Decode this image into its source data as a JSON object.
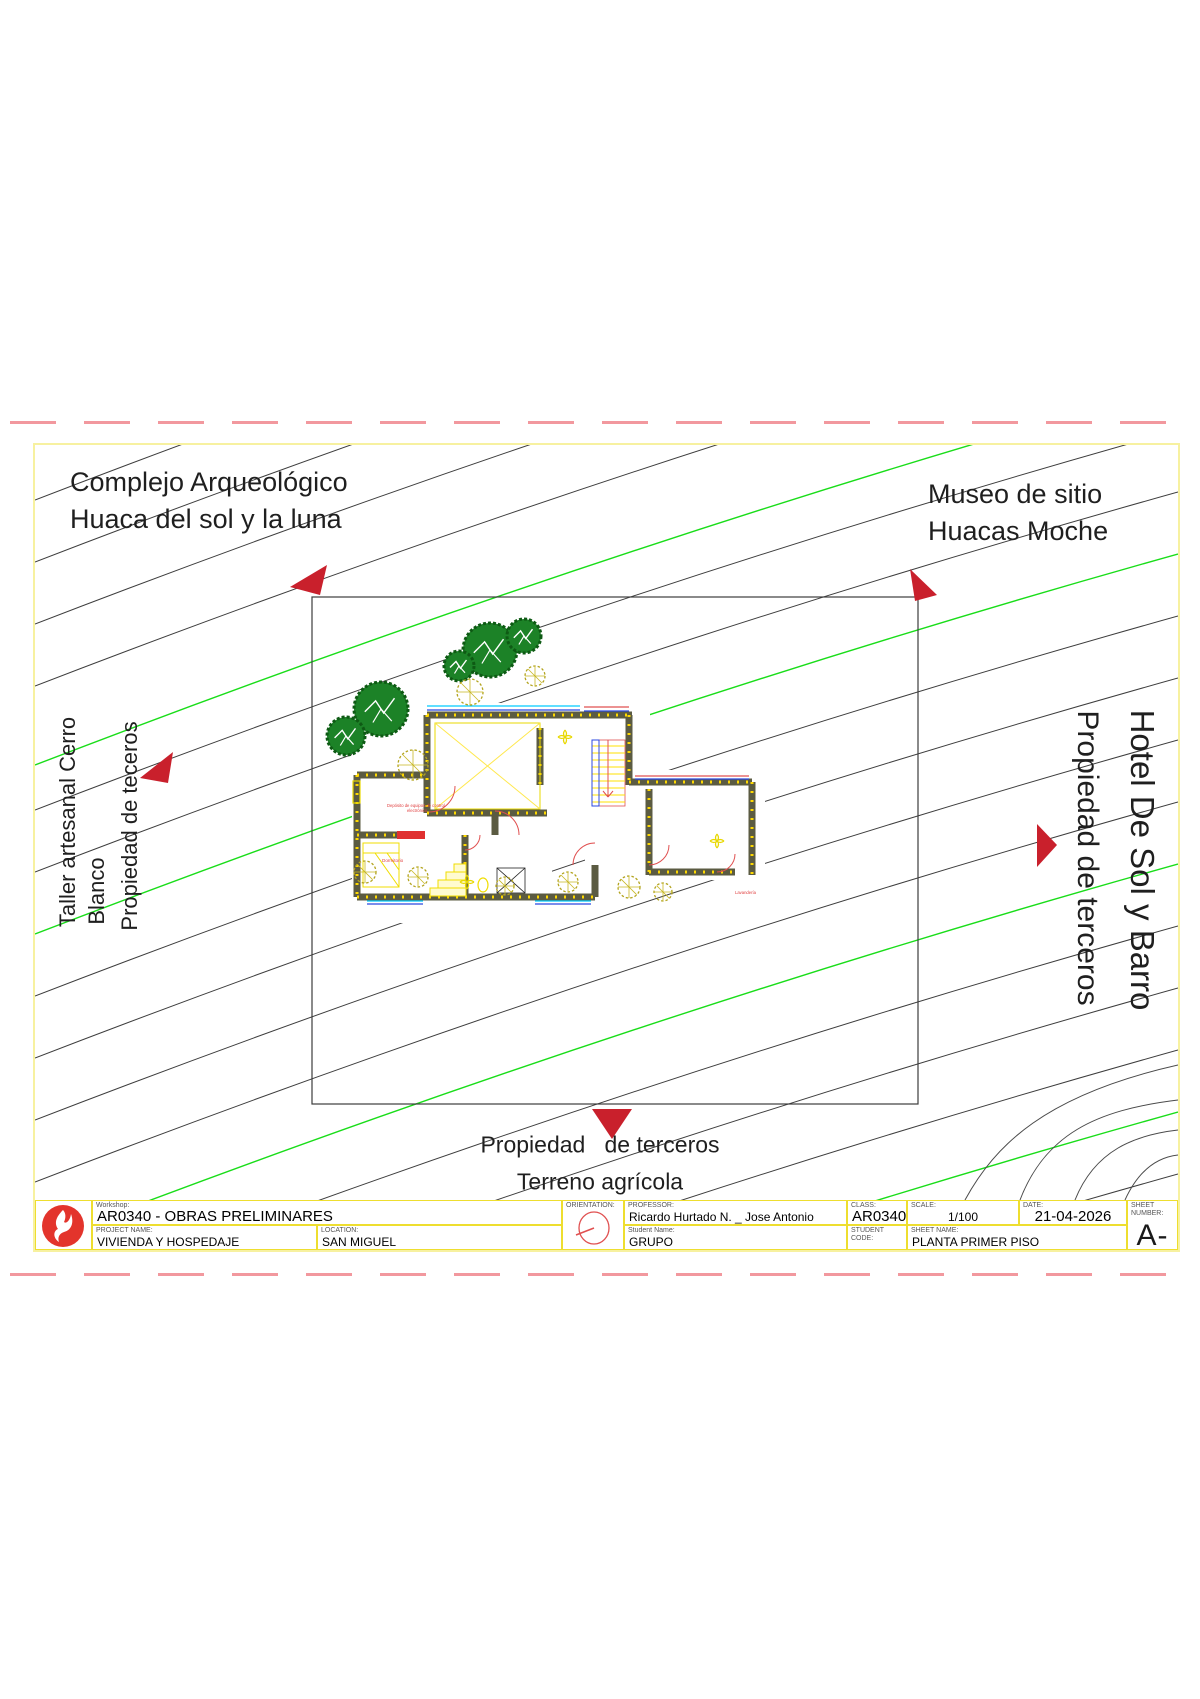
{
  "annotations": {
    "top_left_line1": "Complejo Arqueológico",
    "top_left_line2": "Huaca del sol y la luna",
    "top_right_line1": "Museo de sitio",
    "top_right_line2": "Huacas Moche",
    "left_line1": "Taller artesanal Cerro",
    "left_line2": "Blanco",
    "left_line3": "Propiedad de teceros",
    "right_inner": "Propiedad de terceros",
    "right_outer": "Hotel De Sol y Barro",
    "bottom_line1": "Propiedad   de terceros",
    "bottom_line2": "Terreno agrícola"
  },
  "plan_labels": {
    "storage_line1": "Depósito de equipos de control",
    "storage_line2": "electrónico",
    "bedroom": "Dormitorio",
    "laundry": "Lavandería"
  },
  "titleblock": {
    "workshop_label": "Workshop:",
    "workshop": "AR0340 - OBRAS PRELIMINARES",
    "project_label": "PROJECT NAME:",
    "project": "VIVIENDA Y HOSPEDAJE ECOSOSTENIB.",
    "location_label": "LOCATION:",
    "location": "SAN MIGUEL",
    "orientation_label": "ORIENTATION:",
    "professor_label": "PROFESSOR:",
    "professor": "Ricardo Hurtado N. _ Jose Antonio Yengle C.",
    "student_label": "Student Name:",
    "student": "GRUPO",
    "class_label": "CLASS:",
    "class": "AR0340",
    "student_code_label": "STUDENT CODE:",
    "student_code": "",
    "scale_label": "SCALE:",
    "scale": "1/100",
    "sheet_name_label": "SHEET NAME:",
    "sheet_name": "PLANTA PRIMER PISO",
    "date_label": "DATE:",
    "date": "21-04-2026",
    "sheet_number_label": "SHEET NUMBER:",
    "sheet_number": "A-00"
  },
  "colors": {
    "contour_black": "#3d3d3d",
    "contour_green": "#19dd19",
    "boundary_yellow": "#f7f1a0",
    "titleblock_yellow": "#eede2f",
    "marker_red": "#c9202c",
    "dashed_pink": "#f2989e",
    "logo_red": "#e3342c",
    "wall_dark": "#5b5b42",
    "wall_tick_yellow": "#ffd900",
    "tree_green": "#1c8227"
  }
}
